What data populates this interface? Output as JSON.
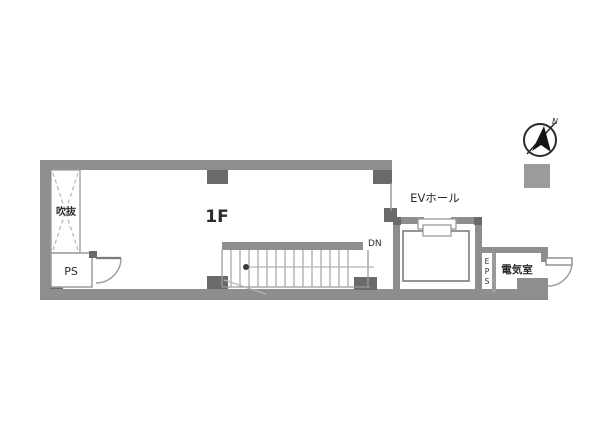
{
  "plan": {
    "floor_label": "1F",
    "rooms": {
      "void_label": "吹抜",
      "ps_label": "PS",
      "ev_hall_label": "EVホール",
      "eps_chars": [
        "E",
        "P",
        "S"
      ],
      "electrical_label": "電気室"
    },
    "stairs": {
      "dn_label": "DN"
    },
    "compass": {
      "north_label": "N"
    }
  },
  "colors": {
    "wall": "#8e8e8e",
    "pillar": "#6a6a6a",
    "line": "#9a9a9a",
    "light_line": "#b5b5b5",
    "text": "#2b2b2b",
    "legend_square": "#9c9c9c",
    "background": "#ffffff"
  }
}
